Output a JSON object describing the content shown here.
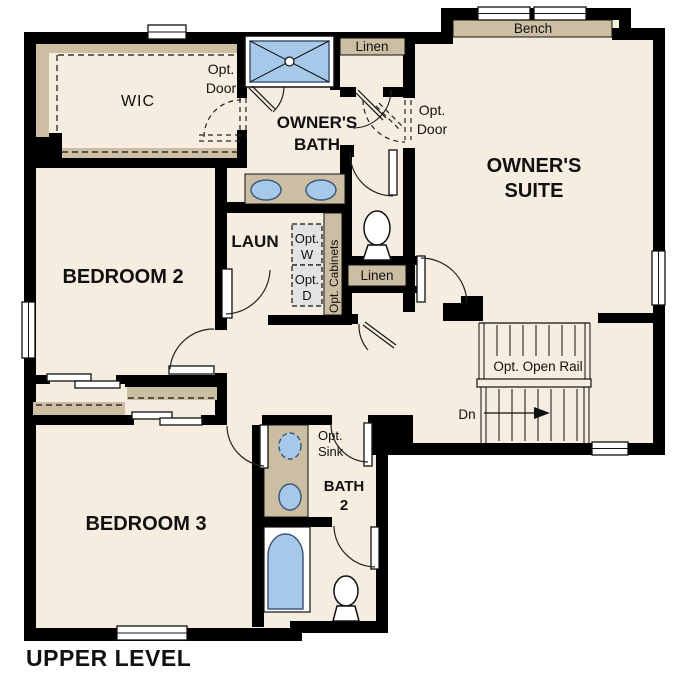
{
  "colors": {
    "floor": "#F5EDDF",
    "wall": "#000000",
    "shelf": "#CCBEA2",
    "fixture_fill": "#A7C9E9",
    "fixture_stroke": "#41597A",
    "appliance_fill": "#E3E3E1"
  },
  "title": "UPPER LEVEL",
  "rooms": {
    "wic": "WIC",
    "owners_bath": [
      "OWNER'S",
      "BATH"
    ],
    "owners_suite": [
      "OWNER'S",
      "SUITE"
    ],
    "bedroom2": "BEDROOM 2",
    "bedroom3": "BEDROOM 3",
    "laundry": "LAUN",
    "bath2": [
      "BATH",
      "2"
    ]
  },
  "annotations": {
    "wic_opt_door": [
      "Opt.",
      "Door"
    ],
    "suite_opt_door": [
      "Opt.",
      "Door"
    ],
    "opt_washer": [
      "Opt.",
      "W"
    ],
    "opt_dryer": [
      "Opt.",
      "D"
    ],
    "opt_cabinets": "Opt. Cabinets",
    "opt_sink": [
      "Opt.",
      "Sink"
    ],
    "opt_open_rail": "Opt. Open Rail",
    "stairs_down": "Dn",
    "bench": "Bench",
    "linen_upper": "Linen",
    "linen_hall": "Linen"
  }
}
